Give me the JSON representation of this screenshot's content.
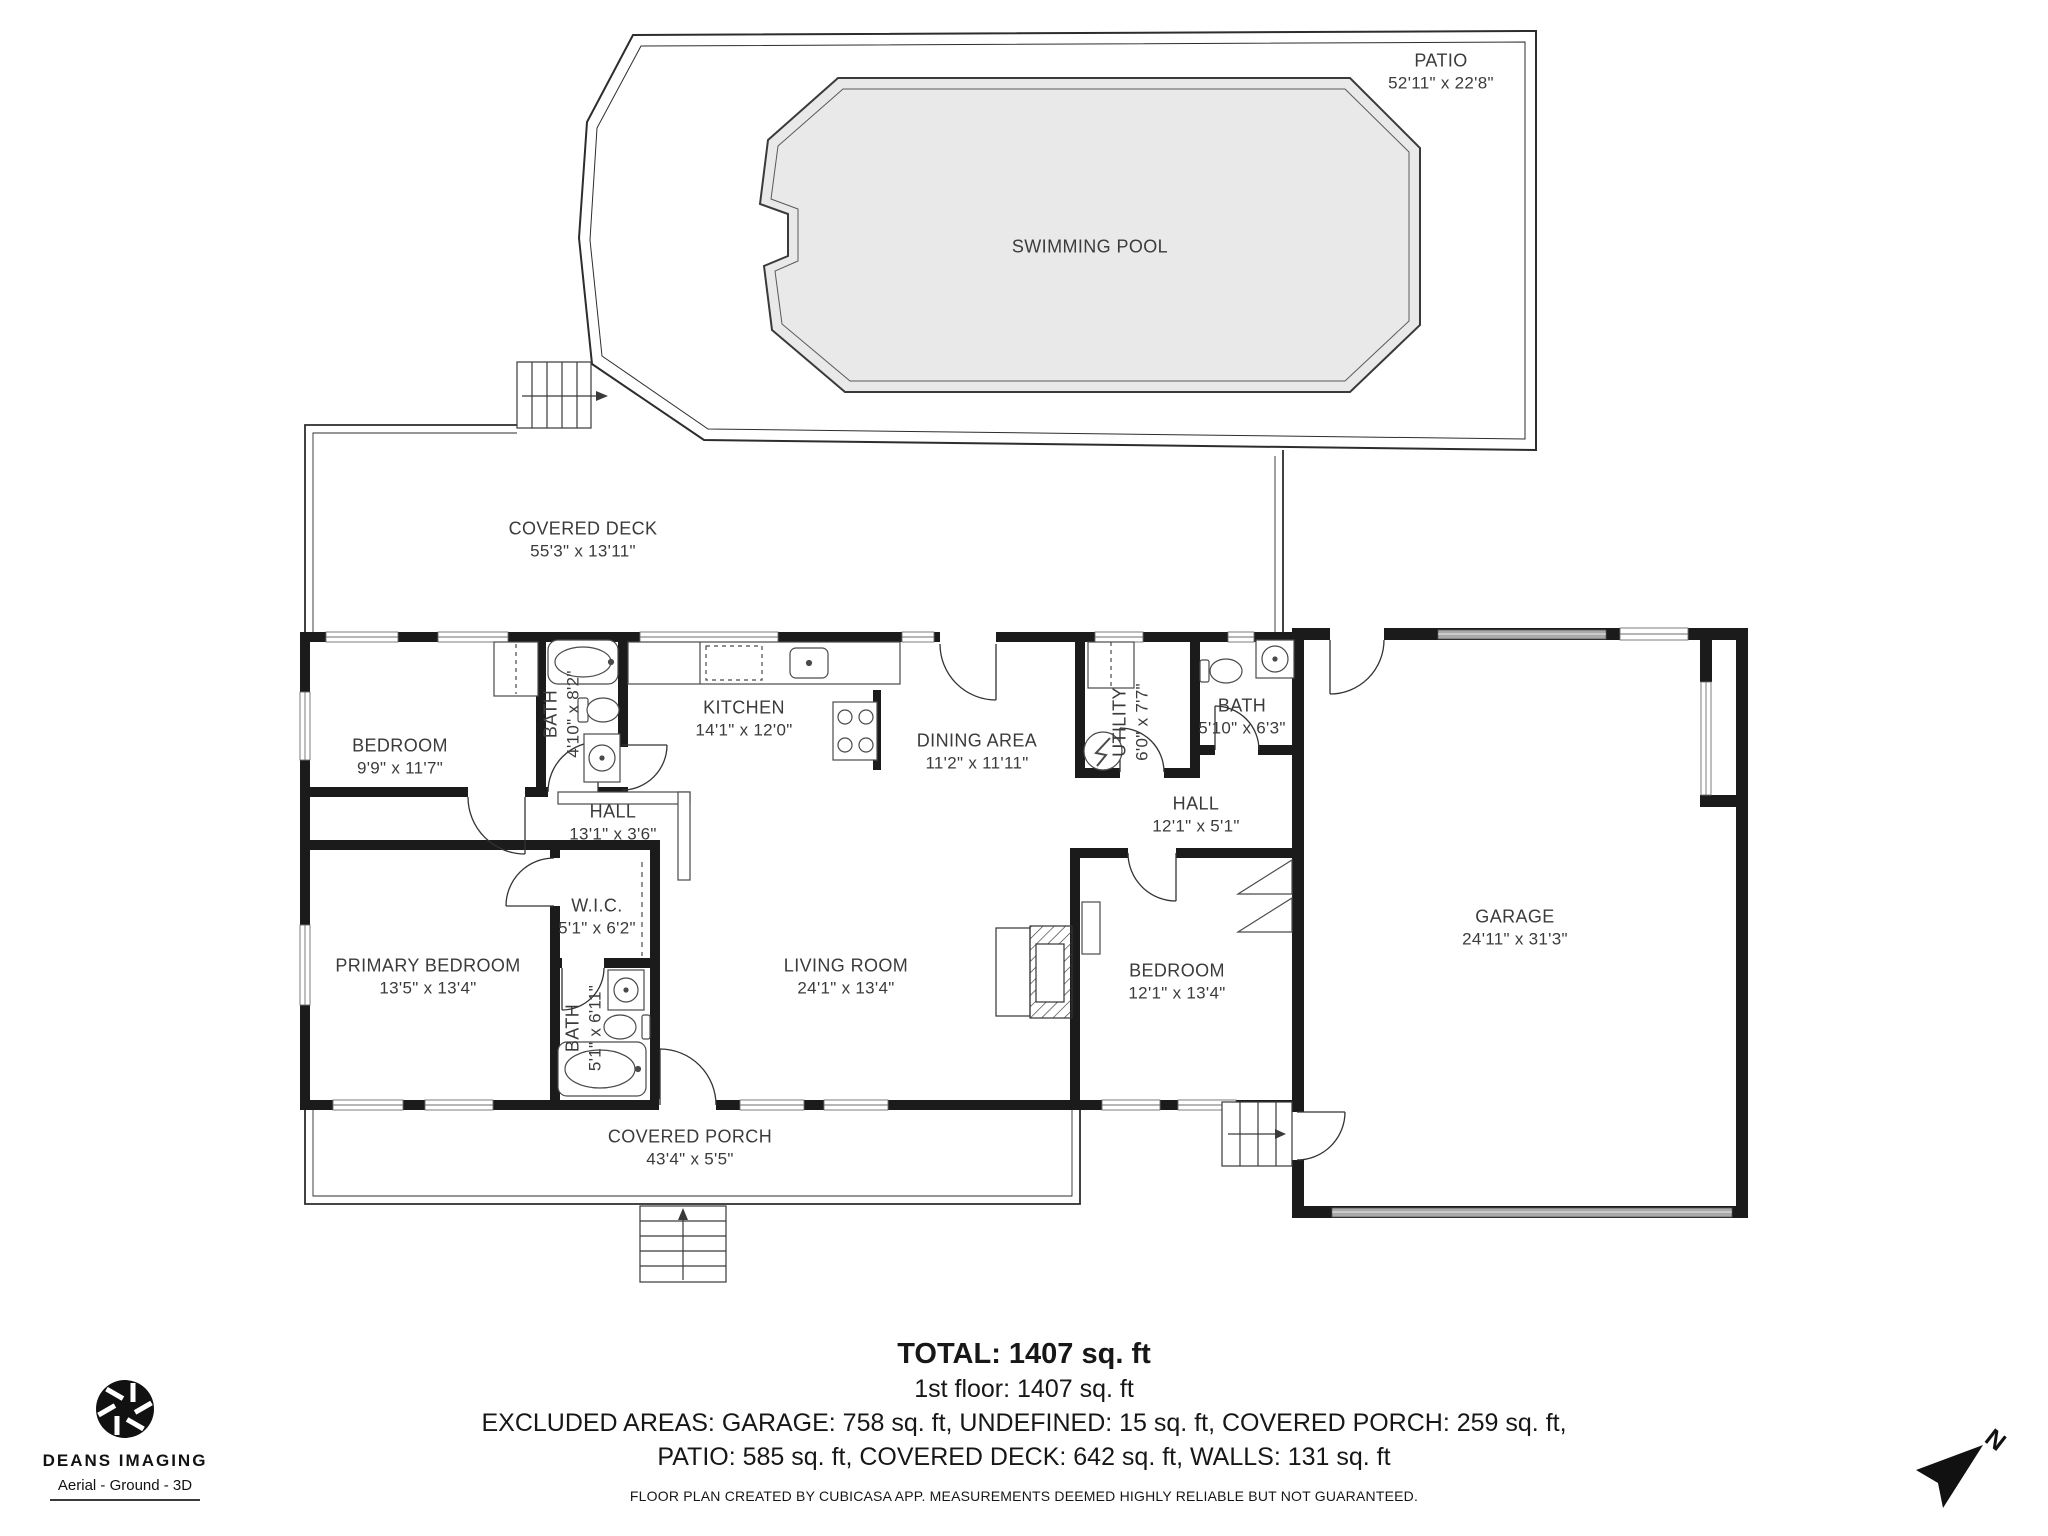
{
  "colors": {
    "wall": "#1b1b1b",
    "pool_fill": "#e9e9e9",
    "thin_line": "#3a3a3a",
    "text": "#3b3b3b"
  },
  "rooms": {
    "patio": {
      "name": "PATIO",
      "dims": "52'11\" x 22'8\""
    },
    "swimming_pool": {
      "name": "SWIMMING POOL"
    },
    "covered_deck": {
      "name": "COVERED DECK",
      "dims": "55'3\" x 13'11\""
    },
    "bedroom1": {
      "name": "BEDROOM",
      "dims": "9'9\" x 11'7\""
    },
    "bath1": {
      "name": "BATH",
      "dims": "4'10\" x 8'2\""
    },
    "kitchen": {
      "name": "KITCHEN",
      "dims": "14'1\" x 12'0\""
    },
    "dining": {
      "name": "DINING AREA",
      "dims": "11'2\" x 11'11\""
    },
    "utility": {
      "name": "UTILITY",
      "dims": "6'0\" x 7'7\""
    },
    "bath2": {
      "name": "BATH",
      "dims": "5'10\" x 6'3\""
    },
    "hall1": {
      "name": "HALL",
      "dims": "13'1\" x 3'6\""
    },
    "hall2": {
      "name": "HALL",
      "dims": "12'1\" x 5'1\""
    },
    "wic": {
      "name": "W.I.C.",
      "dims": "5'1\" x 6'2\""
    },
    "primary_bedroom": {
      "name": "PRIMARY BEDROOM",
      "dims": "13'5\" x 13'4\""
    },
    "bath3": {
      "name": "BATH",
      "dims": "5'1\" x 6'11\""
    },
    "living_room": {
      "name": "LIVING ROOM",
      "dims": "24'1\" x 13'4\""
    },
    "bedroom2": {
      "name": "BEDROOM",
      "dims": "12'1\" x 13'4\""
    },
    "garage": {
      "name": "GARAGE",
      "dims": "24'11\" x 31'3\""
    },
    "covered_porch": {
      "name": "COVERED PORCH",
      "dims": "43'4\" x 5'5\""
    }
  },
  "summary": {
    "total": "TOTAL: 1407 sq. ft",
    "first_floor": "1st floor: 1407 sq. ft",
    "excluded_line1": "EXCLUDED AREAS: GARAGE: 758 sq. ft, UNDEFINED: 15 sq. ft, COVERED PORCH: 259 sq. ft,",
    "excluded_line2": "PATIO: 585 sq. ft, COVERED DECK: 642 sq. ft, WALLS: 131 sq. ft",
    "disclaimer": "FLOOR PLAN CREATED BY CUBICASA APP. MEASUREMENTS DEEMED HIGHLY RELIABLE BUT NOT GUARANTEED."
  },
  "branding": {
    "name": "DEANS IMAGING",
    "tagline": "Aerial - Ground - 3D"
  },
  "compass": {
    "label": "N"
  }
}
